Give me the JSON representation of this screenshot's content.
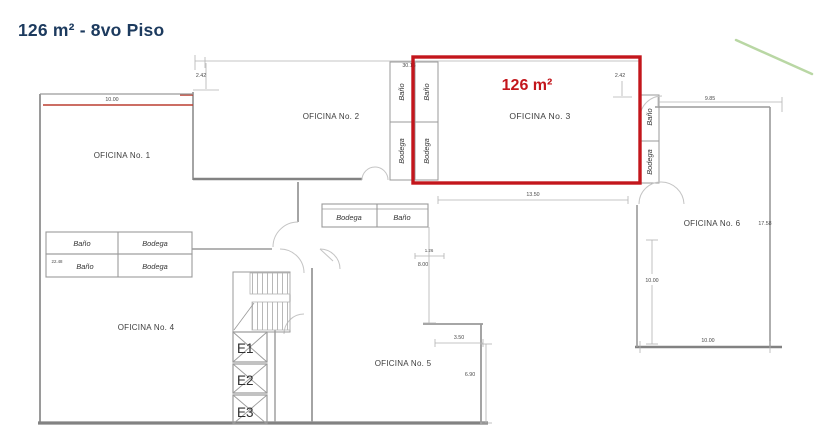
{
  "title": "126 m² - 8vo Piso",
  "highlight": {
    "area": "126 m²",
    "room": "OFICINA No. 3"
  },
  "rooms": {
    "r1": "OFICINA No. 1",
    "r2": "OFICINA No. 2",
    "r3": "OFICINA No. 3",
    "r4": "OFICINA No. 4",
    "r5": "OFICINA No. 5",
    "r6": "OFICINA No. 6"
  },
  "labels": {
    "bano": "Baño",
    "bodega": "Bodega"
  },
  "elevators": {
    "e1": "E1",
    "e2": "E2",
    "e3": "E3"
  },
  "dimensions": {
    "of1_top": "10.00",
    "of2_left": "2.42",
    "top_total": "30.15",
    "of3_right": "2.42",
    "of3_bottom": "13.50",
    "of6_top": "9.85",
    "of6_height": "17.58",
    "of6_left": "10.00",
    "of6_bottom": "10.00",
    "left_height": "22.48",
    "mid_small": "1.26",
    "mid_height": "8.00",
    "of5_top": "3.50",
    "of5_right": "6.90"
  },
  "colors": {
    "highlight": "#c3161c",
    "title": "#1c3a5e",
    "wall": "#9a9a9a",
    "dim_text": "#4a4a4a",
    "green_mark": "#b9d7a4"
  }
}
